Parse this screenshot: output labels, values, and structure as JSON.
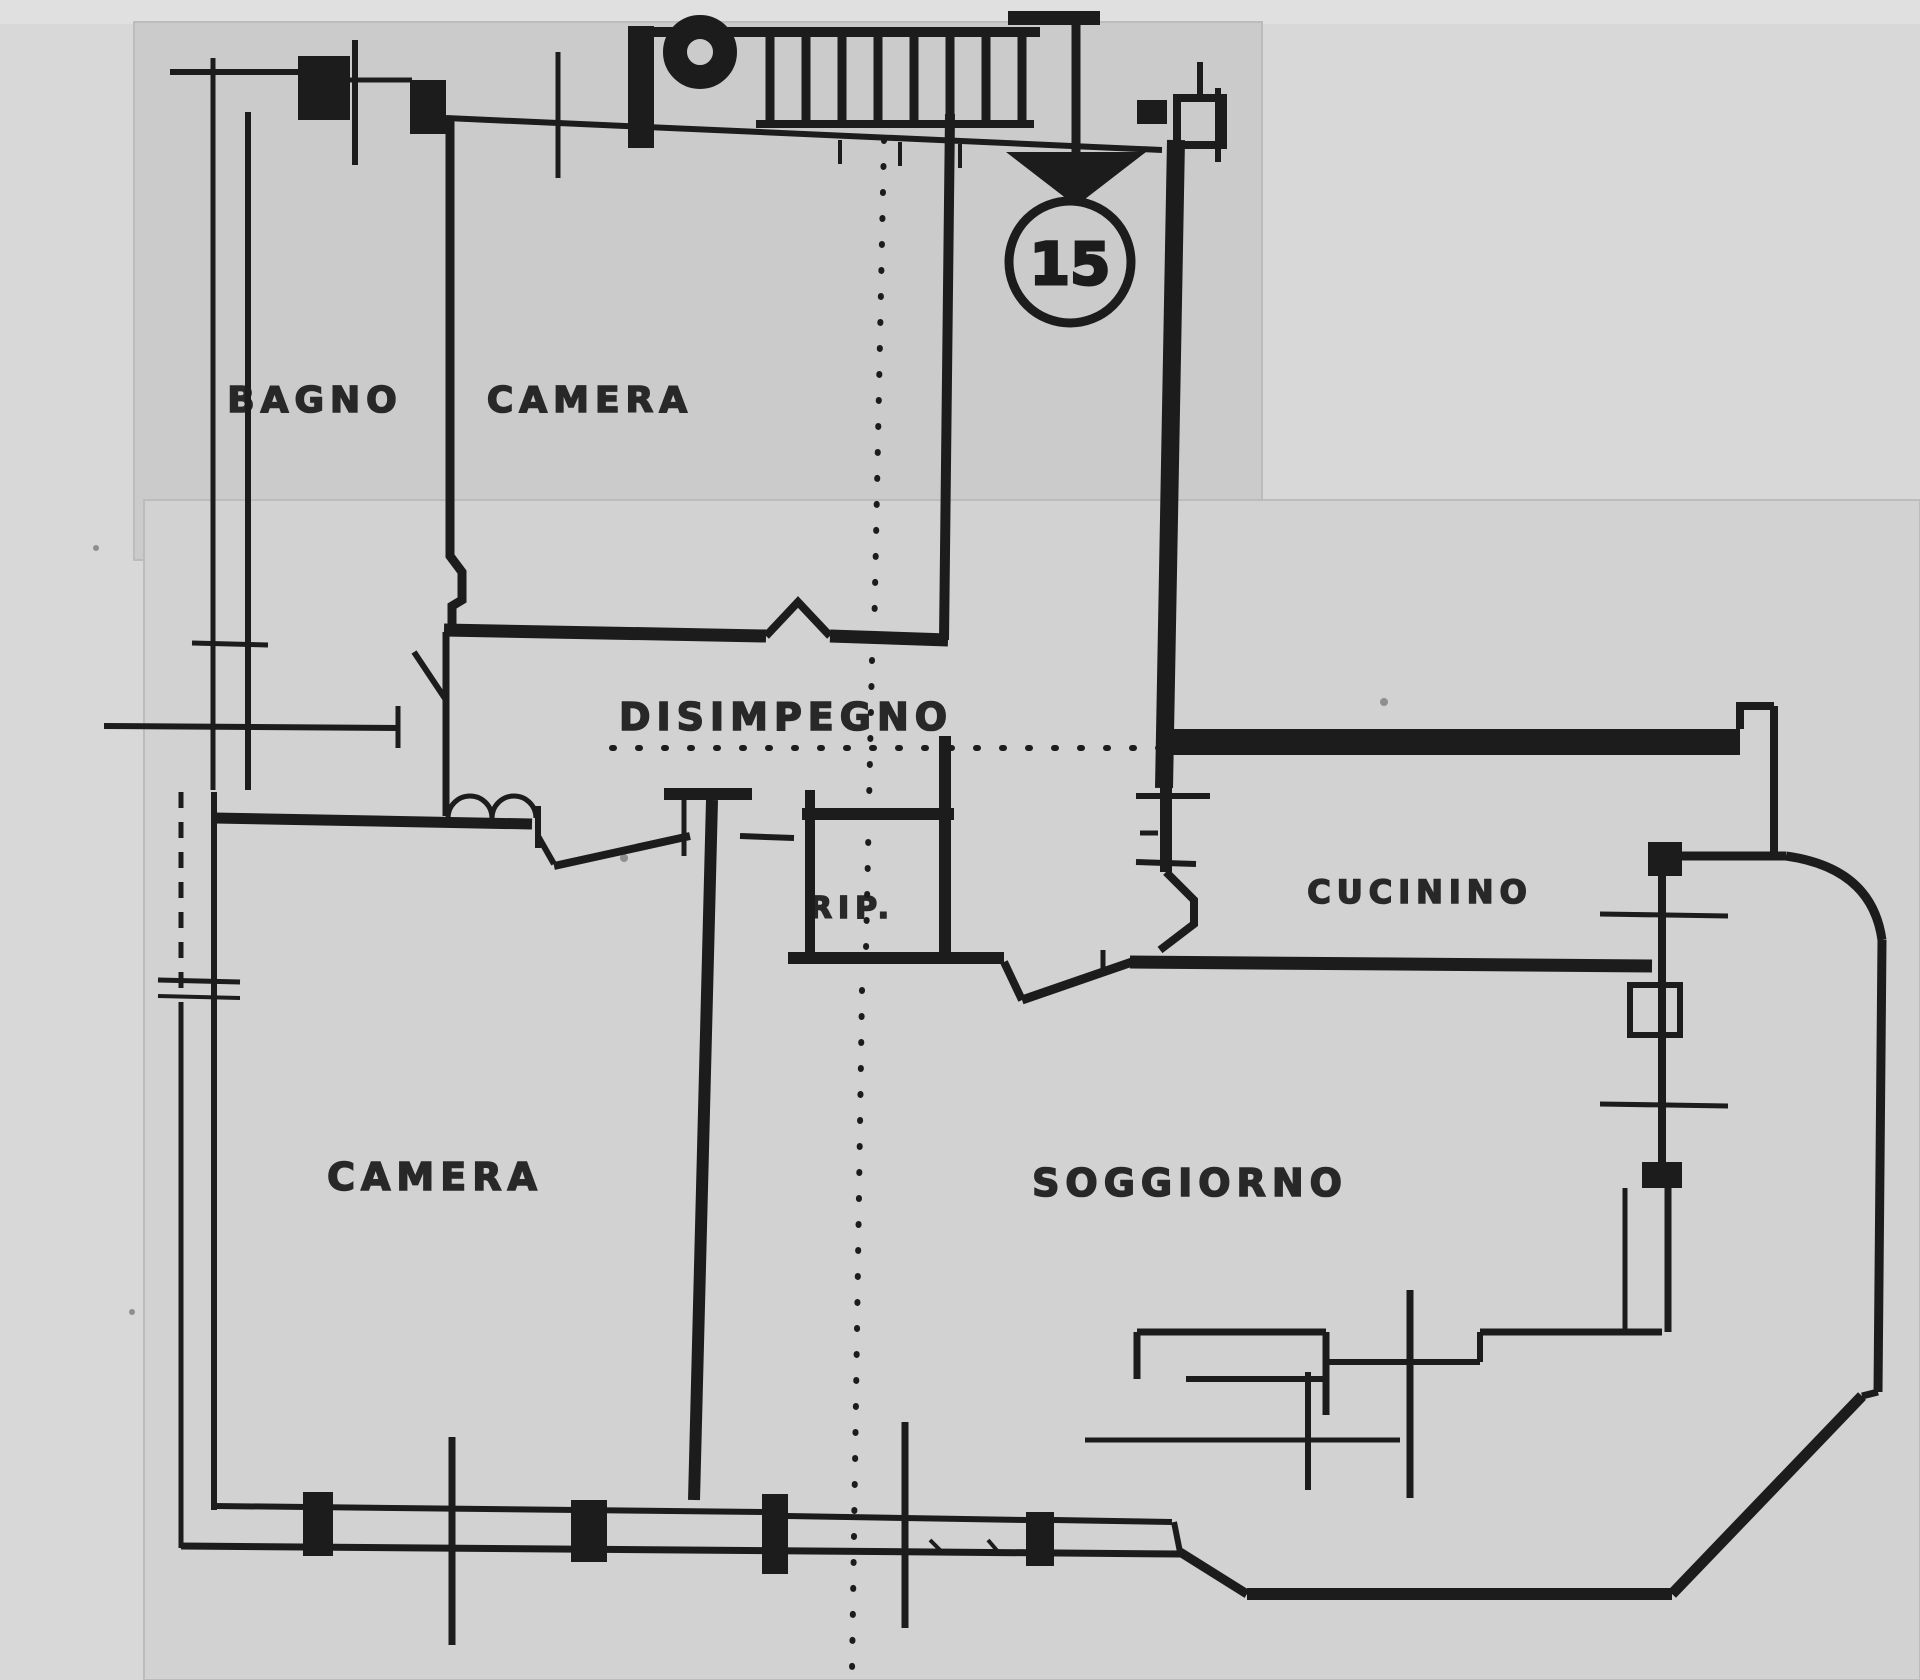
{
  "labels": {
    "bagno": "BAGNO",
    "camera_top": "CAMERA",
    "disimpegno": "DISIMPEGNO",
    "rip": "RIP.",
    "cucinino": "CUCININO",
    "camera_bottom": "CAMERA",
    "soggiorno": "SOGGIORNO",
    "unit_number": "15"
  },
  "colors": {
    "paper": "#d8d8d8",
    "sheet_upper": "#cbcbcb",
    "sheet_lower": "#d2d2d2",
    "ink": "#1c1c1c",
    "seam": "#bcbcbc"
  }
}
